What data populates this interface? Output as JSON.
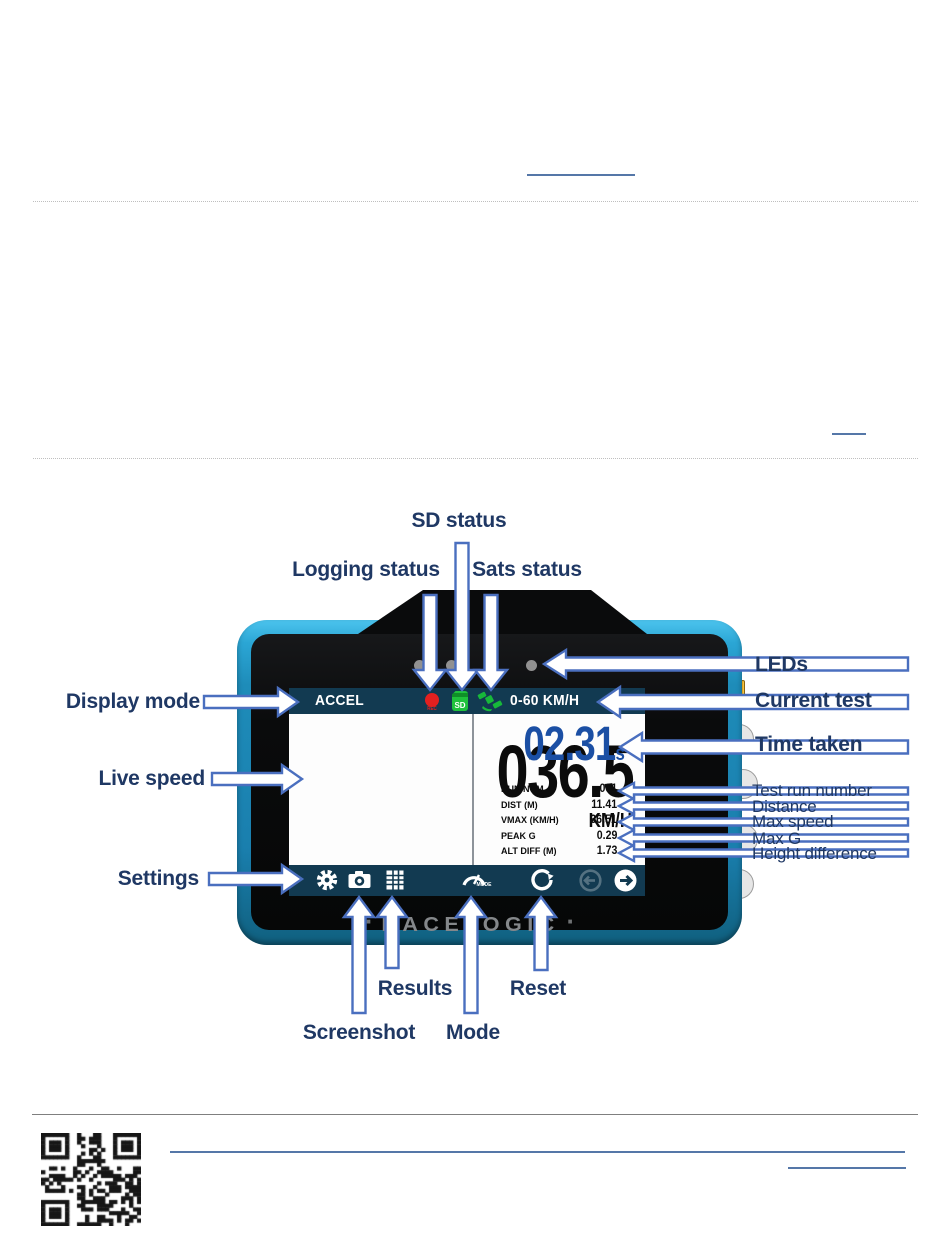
{
  "page": {
    "colors": {
      "label_text": "#1f3864",
      "arrow_stroke": "#4a6fbf",
      "device_body": "#2aa5d6",
      "screen_bar": "#123a51",
      "time_blue": "#1b4fa4",
      "rec_red": "#e3201f",
      "sd_green": "#1fc23c",
      "link_blue": "#5577a8"
    }
  },
  "diagram": {
    "labels": {
      "sd_status": "SD status",
      "logging_status": "Logging status",
      "sats_status": "Sats status",
      "display_mode": "Display mode",
      "live_speed": "Live speed",
      "settings": "Settings",
      "leds": "LEDs",
      "current_test": "Current test",
      "time_taken": "Time taken",
      "test_run_number": "Test run number",
      "distance": "Distance",
      "max_speed": "Max speed",
      "max_g": "Max G",
      "height_difference": "Height difference",
      "results": "Results",
      "reset": "Reset",
      "screenshot": "Screenshot",
      "mode": "Mode"
    },
    "device": {
      "brand": "RACELOGIC",
      "brand_dot": "·",
      "screen": {
        "display_mode": "ACCEL",
        "current_test": "0-60 KM/H",
        "live_speed": "036.5",
        "speed_units": "KM/H",
        "time_taken": "02.31",
        "time_units": "s",
        "rec_label": "REC",
        "sd_label": "SD",
        "mode_label": "MODE",
        "stats": [
          {
            "label": "RUN NUM",
            "value": "001"
          },
          {
            "label": "DIST (M)",
            "value": "11.41"
          },
          {
            "label": "VMAX (KM/H)",
            "value": "36.51"
          },
          {
            "label": "PEAK G",
            "value": "0.29"
          },
          {
            "label": "ALT DIFF (M)",
            "value": "1.73"
          }
        ]
      }
    }
  }
}
